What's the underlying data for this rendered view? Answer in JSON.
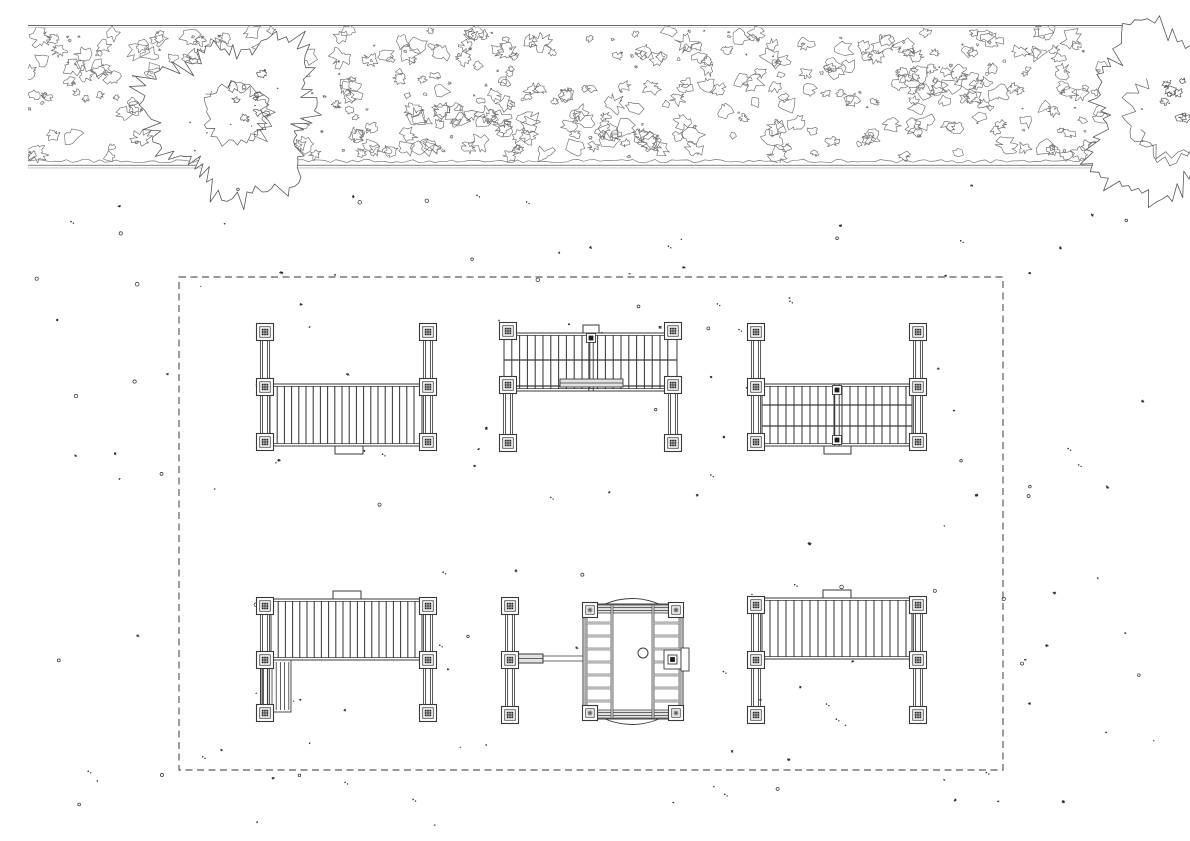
{
  "canvas": {
    "width": 1190,
    "height": 841,
    "background": "#ffffff"
  },
  "colors": {
    "line": "#3a3a3a",
    "hedge": "#6e6e6e",
    "tree": "#585858",
    "scallop": "#7a7a7a",
    "gray_line": "#9a9a9a",
    "gray_line2": "#bdbdbd",
    "gray_fill": "#e2e2e2",
    "post_core": "#1d1d1d",
    "scatter": "#2e2e2e",
    "boundary": "#5c5c5c",
    "white": "#ffffff"
  },
  "hedge": {
    "x1": 28,
    "x2": 1163,
    "y1": 26,
    "y2": 163,
    "top_line_y": 25.5,
    "top_line2_y": 27.4,
    "bottom_line_y1": 165.4,
    "bottom_line_y2": 167.9,
    "blob_count": 390,
    "speck_count": 120,
    "seed": 7
  },
  "trees": [
    {
      "name": "tree-canopy-left",
      "cx": 235,
      "cy": 115,
      "r": 100,
      "seed": 5
    },
    {
      "name": "tree-canopy-right",
      "cx": 1175,
      "cy": 115,
      "r": 105,
      "seed": 9
    }
  ],
  "boundary": {
    "x": 179,
    "y": 277,
    "width": 824,
    "height": 493,
    "dash": "7 4.5"
  },
  "scatter": {
    "count": 155,
    "seed": 42,
    "x1": 22,
    "y1": 185,
    "x2": 1168,
    "y2": 832
  },
  "structures": [
    {
      "id": "pergola-frame-nw",
      "type": "frame",
      "left_x": 265,
      "right_x": 428,
      "post_ys": [
        332,
        387,
        442
      ],
      "rail_y1": 324,
      "rail_y2": 450,
      "band": {
        "x1": 270,
        "y1": 384,
        "x2": 422,
        "y2": 446,
        "spacing": 7.2,
        "midlines": [],
        "divider": null
      },
      "tabs": [
        {
          "x": 335,
          "y": 446,
          "w": 28,
          "h": 8
        }
      ]
    },
    {
      "id": "bridge-deck-n",
      "type": "frame",
      "left_x": 508,
      "right_x": 673,
      "post_ys": [
        331,
        385,
        443
      ],
      "rail_y1": 390,
      "rail_y2": 450,
      "band": {
        "x1": 504,
        "y1": 333,
        "x2": 677,
        "y2": 391,
        "spacing": 7.8,
        "midlines": [
          360,
          386
        ],
        "divider": {
          "x": 591,
          "post_ys": [
            338
          ]
        }
      },
      "bench": {
        "x": 560,
        "y": 379,
        "w": 63,
        "h": 8
      },
      "tabs": [
        {
          "x": 583,
          "y": 325,
          "w": 16,
          "h": 8
        }
      ]
    },
    {
      "id": "pergola-frame-ne",
      "type": "frame",
      "left_x": 756,
      "right_x": 918,
      "post_ys": [
        332,
        387,
        442
      ],
      "rail_y1": 324,
      "rail_y2": 450,
      "band": {
        "x1": 762,
        "y1": 384,
        "x2": 912,
        "y2": 446,
        "spacing": 8,
        "midlines": [
          405,
          426
        ],
        "divider": {
          "x": 837,
          "post_ys": [
            390,
            440
          ]
        }
      },
      "tabs": [
        {
          "x": 824,
          "y": 446,
          "w": 27,
          "h": 8
        }
      ]
    },
    {
      "id": "deck-frame-sw",
      "type": "frame",
      "left_x": 265,
      "right_x": 428,
      "post_ys": [
        606,
        660,
        713
      ],
      "rail_y1": 598,
      "rail_y2": 721,
      "band": {
        "x1": 271,
        "y1": 599,
        "x2": 422,
        "y2": 660,
        "spacing": 7.2,
        "midlines": [],
        "divider": null
      },
      "subpanel": {
        "x1": 261,
        "y1": 660,
        "x2": 291,
        "y2": 712,
        "spacing": 4.2
      },
      "tabs": [
        {
          "x": 333,
          "y": 591,
          "w": 28,
          "h": 8
        }
      ]
    },
    {
      "id": "play-cabin-s",
      "type": "cabin",
      "side_rail": {
        "x": 510,
        "y1": 598,
        "y2": 716,
        "post_ys": [
          606,
          660,
          715
        ]
      },
      "bench": {
        "x": 512,
        "y": 654,
        "w": 31,
        "h": 9,
        "line_to_x": 583
      },
      "box": {
        "x1": 583,
        "y1": 604,
        "x2": 683,
        "y2": 719
      },
      "corner_posts": [
        [
          590,
          610
        ],
        [
          676,
          610
        ],
        [
          590,
          713
        ],
        [
          676,
          713
        ]
      ],
      "top_rail": {
        "y1": 605,
        "y2": 613
      },
      "bottom_rail": {
        "y1": 710,
        "y2": 718
      },
      "ladder_cols": [
        [
          585,
          587
        ],
        [
          611,
          613
        ],
        [
          652,
          654
        ],
        [
          679,
          681
        ]
      ],
      "rungs": {
        "left": [
          587,
          611
        ],
        "right": [
          654,
          679
        ],
        "ys": [
          622,
          635,
          648,
          661,
          674,
          687,
          700
        ]
      },
      "circle": {
        "cx": 643,
        "cy": 653,
        "r": 5
      },
      "side_box": {
        "x": 664,
        "y": 650,
        "w": 17,
        "h": 19,
        "tab": {
          "x": 681,
          "y": 648,
          "w": 8,
          "h": 23
        }
      },
      "arcs": {
        "x1": 605,
        "x2": 659,
        "top_y": 604,
        "bottom_y": 719,
        "bulge": 11
      }
    },
    {
      "id": "deck-frame-se",
      "type": "frame",
      "left_x": 756,
      "right_x": 918,
      "post_ys": [
        605,
        660,
        715
      ],
      "rail_y1": 597,
      "rail_y2": 723,
      "band": {
        "x1": 762,
        "y1": 598,
        "x2": 912,
        "y2": 659,
        "spacing": 8,
        "midlines": [],
        "divider": null
      },
      "tabs": [
        {
          "x": 823,
          "y": 590,
          "w": 28,
          "h": 8
        }
      ]
    }
  ]
}
